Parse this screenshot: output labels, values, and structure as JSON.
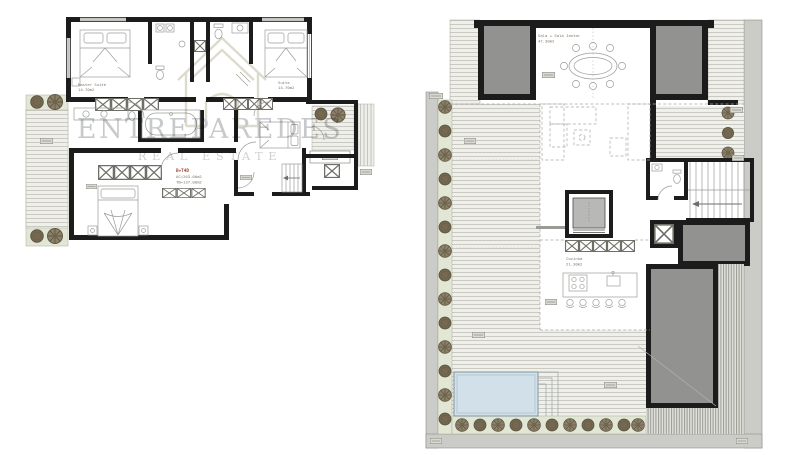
{
  "watermark": {
    "brand": "ENTREPAREDES",
    "tagline": "REAL ESTATE"
  },
  "left_plan": {
    "name": "bedroom-floor-plan",
    "title_block": {
      "typology": "B+T4D",
      "line1": "AC=203.00m2",
      "line2": "TB=137.00m2"
    },
    "rooms": [
      {
        "id": "master-suite",
        "label": "Master Suite",
        "area": "14.70m2"
      },
      {
        "id": "suite",
        "label": "Suite",
        "area": "14.70m2"
      }
    ]
  },
  "right_plan": {
    "name": "living-floor-plan",
    "rooms": [
      {
        "id": "living-dining",
        "label": "Sala + Sala Jantar",
        "area": "47.30m2"
      },
      {
        "id": "kitchen",
        "label": "Cozinha",
        "area": "21.30m2"
      }
    ]
  },
  "colors": {
    "wall": "#1c1c1c",
    "deck_line": "#cacac3",
    "garden_green": "#e2e7d5",
    "plant_brown": "#746851",
    "skylight_gray": "#929290",
    "pool_blue": "#d2e1e9",
    "watermark_gray": "#c7cacd",
    "annotation_red": "#9e3f2c"
  }
}
